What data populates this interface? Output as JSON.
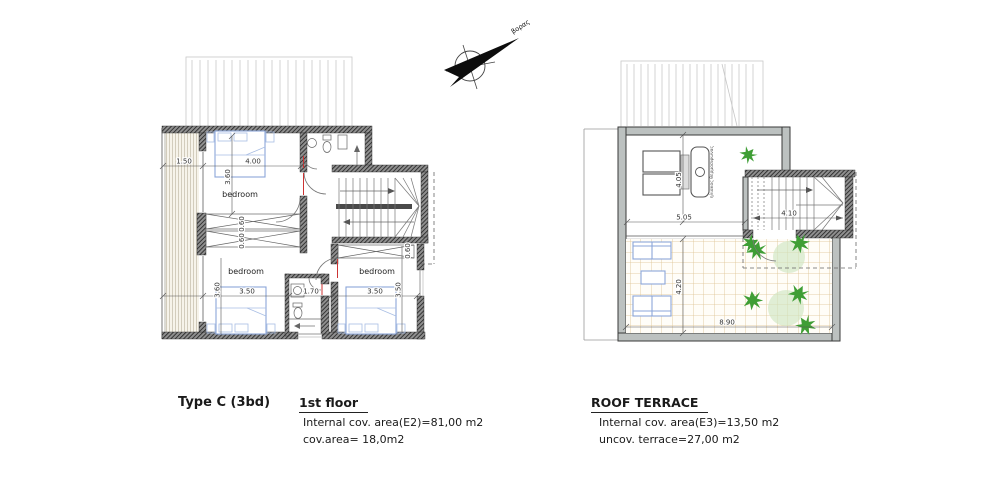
{
  "compass": {
    "label": "βορας"
  },
  "first_floor": {
    "type_label": "Type C (3bd)",
    "floor_label": "1st floor",
    "note1": "Internal cov. area(E2)=81,00 m2",
    "note2": "cov.area= 18,0m2",
    "room1": "bedroom",
    "room2": "bedroom",
    "room3": "bedroom",
    "dims": {
      "balcony": "1.50",
      "bed1_w": "4.00",
      "bed1_d": "3.60",
      "ward_a": "0.60",
      "ward_b": "0.60",
      "bed2_d": "3.60",
      "bed2_w": "3.50",
      "bath_w": "1.70",
      "bed3_w": "3.50",
      "bed3_d": "3.50",
      "ward_c": "0.60"
    }
  },
  "roof_terrace": {
    "title": "ROOF TERRACE",
    "note1": "Internal cov. area(E3)=13,50 m2",
    "note2": "uncov. terrace=27,00 m2",
    "solar_label": "ηλιακος θερμοσιφωνας",
    "dims": {
      "covered_d": "4.05",
      "covered_w": "5.05",
      "stair_w": "4.10",
      "terrace_d": "4.20",
      "terrace_w": "8.90"
    }
  },
  "colors": {
    "wall_dark": "#3e3e3e",
    "wall_gray": "#bcc1c0",
    "furniture_blue": "#8ba6d9",
    "tile_tan": "#dcc190",
    "plant_green": "#3f9e35",
    "door_mark_red": "#cc3333"
  }
}
